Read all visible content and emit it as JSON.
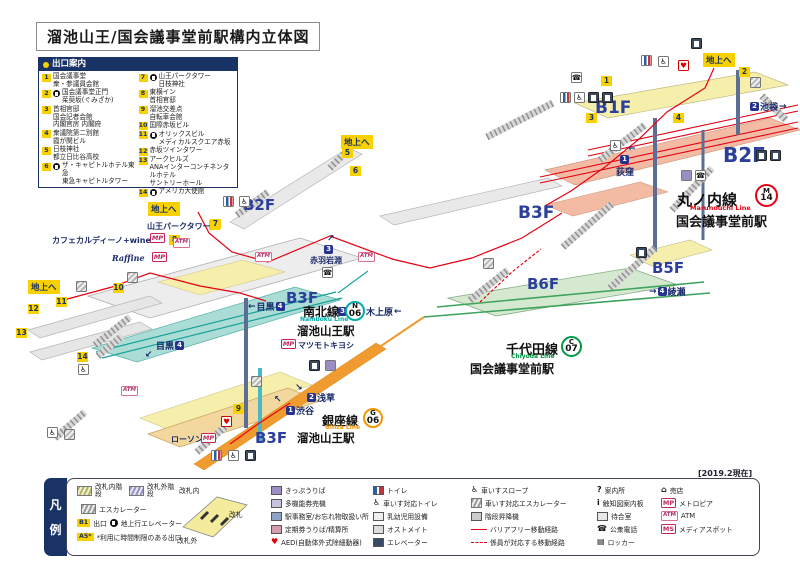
{
  "title": "溜池山王/国会議事堂前駅構内立体図",
  "as_of": "[2019.2現在]",
  "to_ground": "地上へ",
  "glyphs": {
    "mp": "MP",
    "atm": "ATM",
    "ms": "MS",
    "b1": "B1",
    "a5": "A5*",
    "aed": "♥",
    "phone": "☎",
    "wc": "♿",
    "q": "?",
    "i": "i",
    "locker": "▤",
    "shop": "⌂"
  },
  "exit_guide": {
    "header": "出口案内",
    "entries_left": [
      {
        "no": "1",
        "lines": [
          "国会議事堂",
          "衆・参議員会館"
        ]
      },
      {
        "no": "2",
        "ev": true,
        "lines": [
          "国会議事堂正門",
          "茱萸坂(ぐみざか)"
        ]
      },
      {
        "no": "3",
        "lines": [
          "首相官邸",
          "国会記者会館",
          "内閣官房 内閣府"
        ]
      },
      {
        "no": "4",
        "lines": [
          "衆議院第二別館",
          "霞が関ビル"
        ]
      },
      {
        "no": "5",
        "lines": [
          "日枝神社",
          "都立日比谷高校"
        ]
      },
      {
        "no": "6",
        "ev": true,
        "lines": [
          "ザ・キャピトルホテル東急",
          "東急キャピトルタワー"
        ]
      }
    ],
    "entries_right": [
      {
        "no": "7",
        "ev": true,
        "lines": [
          "山王パークタワー",
          "日枝神社"
        ]
      },
      {
        "no": "8",
        "lines": [
          "東横イン",
          "首相官邸"
        ]
      },
      {
        "no": "9",
        "lines": [
          "溜池交差点",
          "自転車会館"
        ]
      },
      {
        "no": "10",
        "lines": [
          "国際赤坂ビル"
        ]
      },
      {
        "no": "11",
        "ev": true,
        "lines": [
          "オリックスビル",
          "メディカルスクエア赤坂"
        ]
      },
      {
        "no": "12",
        "lines": [
          "赤坂ツインタワー"
        ]
      },
      {
        "no": "13",
        "lines": [
          "アークヒルズ",
          "ANAインターコンチネンタルホテル",
          "サントリーホール"
        ]
      },
      {
        "no": "14",
        "ev": true,
        "lines": [
          "アメリカ大使館"
        ]
      }
    ]
  },
  "floor_labels": {
    "b1f": "B1F",
    "b2f_right": "B2F",
    "b2f_left": "B2F",
    "b3f_right": "B3F",
    "b3f_namboku": "B3F",
    "b3f_ginza": "B3F",
    "b5f": "B5F",
    "b6f": "B6F"
  },
  "lines": {
    "marunouchi": {
      "name": "丸ノ内線",
      "en": "Marunouchi Line",
      "symbol": "M",
      "number": "14",
      "station": "国会議事堂前駅",
      "color": "#e60012"
    },
    "namboku": {
      "name": "南北線",
      "en": "Namboku Line",
      "symbol": "N",
      "number": "06",
      "station": "溜池山王駅",
      "color": "#00ada9"
    },
    "chiyoda": {
      "name": "千代田線",
      "en": "Chiyoda Line",
      "symbol": "C",
      "number": "07",
      "station": "国会議事堂前駅",
      "color": "#009944"
    },
    "ginza": {
      "name": "銀座線",
      "en": "Ginza Line",
      "symbol": "G",
      "number": "06",
      "station": "溜池山王駅",
      "color": "#f39700"
    }
  },
  "directions": {
    "ikebukuro": {
      "badge": "2",
      "text": "池袋"
    },
    "ogikubo": {
      "badge": "1",
      "text": "荻窪"
    },
    "akabane_iwabuchi": {
      "badge": "3",
      "text": "赤羽岩淵"
    },
    "meguro_a": {
      "badge": "4",
      "text": "目黒"
    },
    "meguro_b": {
      "badge": "4",
      "text": "目黒"
    },
    "asakusa": {
      "badge": "2",
      "text": "浅草"
    },
    "shibuya": {
      "badge": "1",
      "text": "渋谷"
    },
    "ayase": {
      "badge": "4",
      "text": "綾瀬"
    },
    "yoyogi_uehara": {
      "badge": "3",
      "text": "代々木上原"
    }
  },
  "map_exit_badges": [
    "1",
    "2",
    "3",
    "4",
    "5",
    "6",
    "7",
    "8",
    "9",
    "10",
    "11",
    "12",
    "13",
    "14"
  ],
  "to_sanno": {
    "text": "山王パークタワーへ",
    "badge": "7"
  },
  "shops": {
    "cafe": "カフェカルディーノ+wine",
    "raffine": "Raffine",
    "matsukiyo": "マツモトキヨシ",
    "lawson": "ローソン"
  },
  "legend": {
    "tab1": "凡",
    "tab2": "例",
    "stairs_inside": "改札内階段",
    "stairs_outside": "改札外階段",
    "escalator": "エスカレーター",
    "exit_label": "出口",
    "ground_ev": "地上行エレベーター",
    "restricted": "*利用に時間制限のある出口",
    "gate_inside": "改札内",
    "gate": "改札",
    "gate_outside": "改札外",
    "col2": [
      "きっぷうりば",
      "多機能券売機",
      "駅事務室/お忘れ物取扱い所",
      "定期券うりば/精算所",
      "AED(自動体外式除細動器)"
    ],
    "col3": [
      "トイレ",
      "車いす対応トイレ",
      "乳幼児用設備",
      "オストメイト",
      "エレベーター"
    ],
    "col4": [
      "車いすスロープ",
      "車いす対応エスカレーター",
      "階段昇降機",
      "バリアフリー移動経路",
      "係員が対応する移動経路"
    ],
    "col5": [
      "案内所",
      "触知図案内板",
      "待合室",
      "公衆電話",
      "ロッカー"
    ],
    "col6": [
      "売店",
      "メトロピア",
      "ATM",
      "メディアスポット"
    ]
  }
}
